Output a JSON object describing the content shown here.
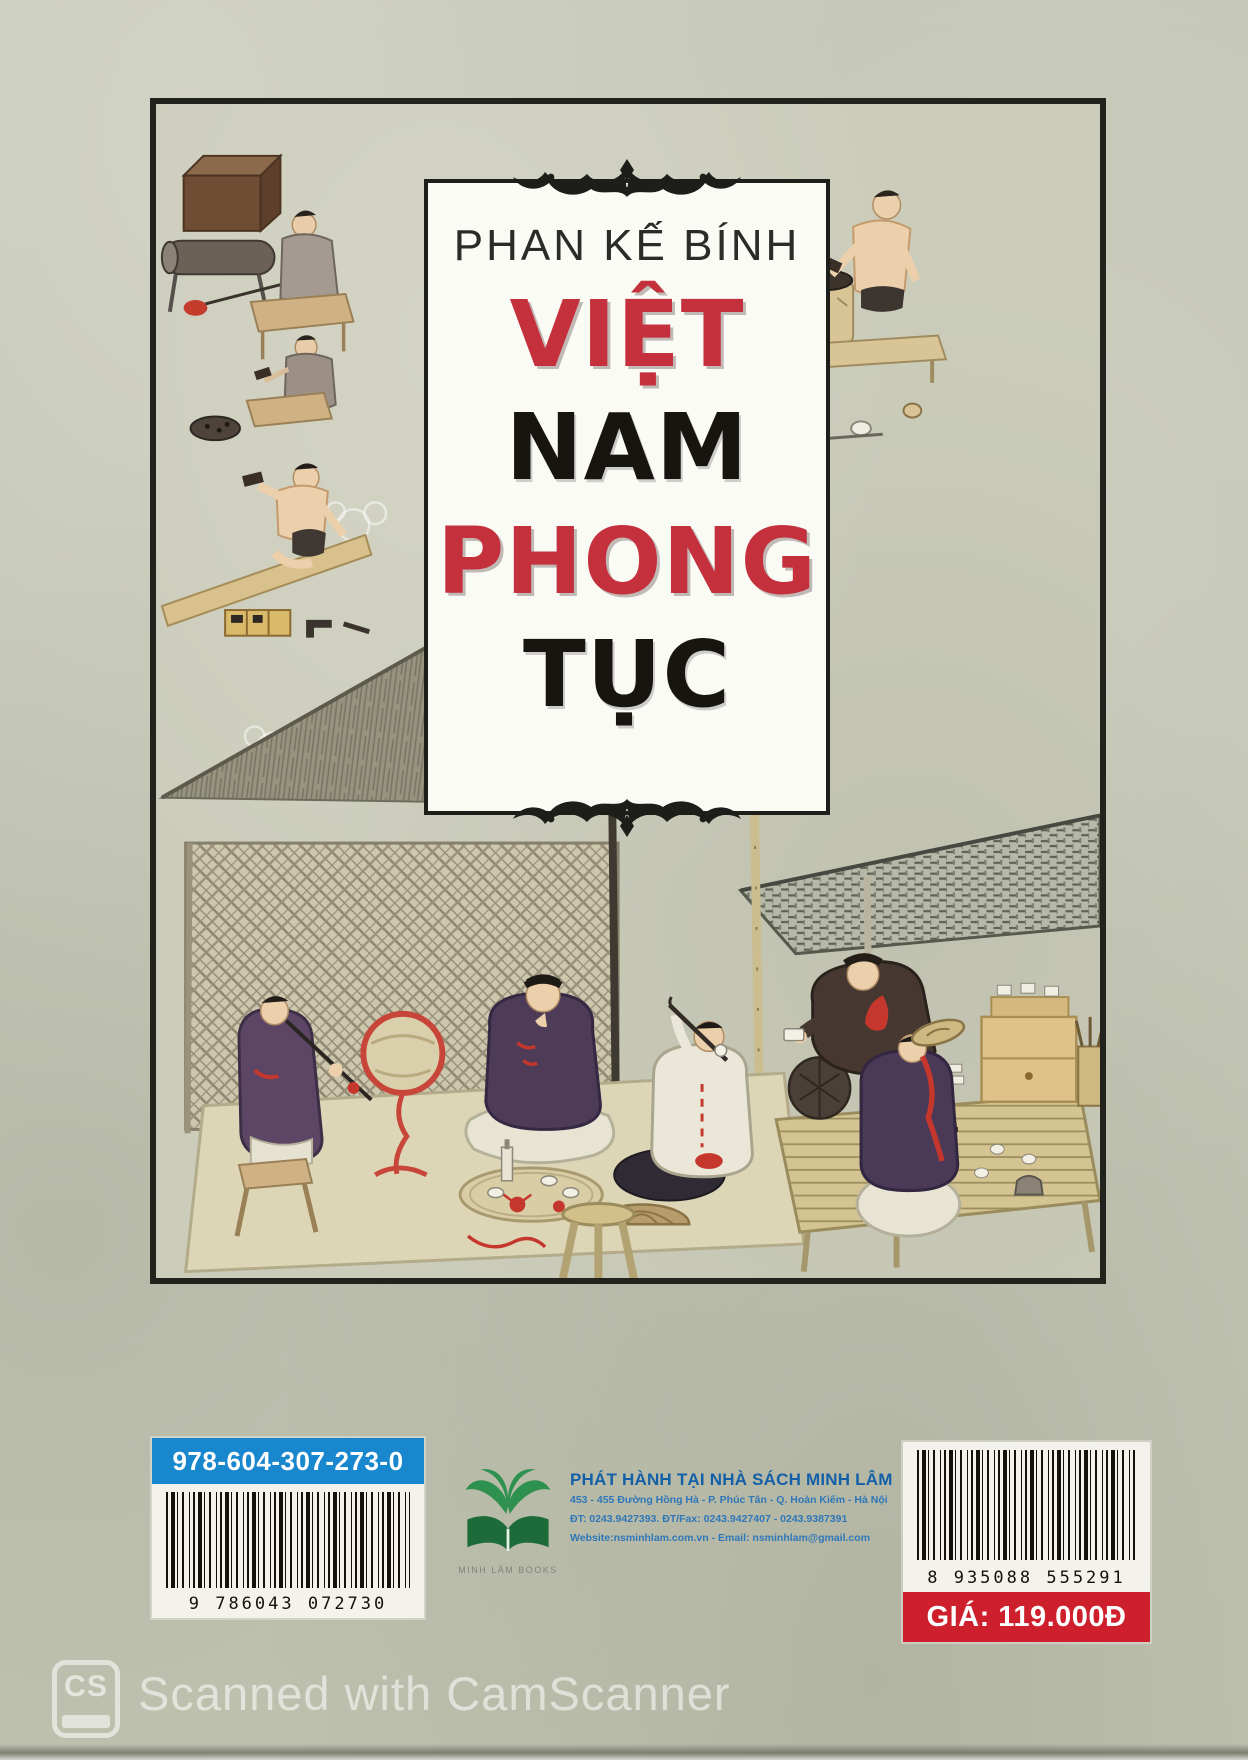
{
  "cover": {
    "author": "PHAN KẾ BÍNH",
    "words": [
      "VIỆT",
      "NAM",
      "PHONG",
      "TỤC"
    ]
  },
  "isbn": {
    "label": "978-604-307-273-0",
    "digits": "9 786043 072730"
  },
  "publisher": {
    "logo_caption": "MINH LÂM BOOKS",
    "lines": [
      "PHÁT HÀNH TẠI NHÀ SÁCH MINH LÂM",
      "453 - 455 Đường Hồng Hà - P. Phúc Tân - Q. Hoàn Kiếm - Hà Nội",
      "ĐT: 0243.9427393. ĐT/Fax: 0243.9427407 - 0243.9387391",
      "Website:nsminhlam.com.vn - Email: nsminhlam@gmail.com"
    ]
  },
  "price": {
    "digits": "8 935088 555291",
    "label": "GIÁ: 119.000Đ"
  },
  "watermark": {
    "logo_text": "CS",
    "text": "Scanned with CamScanner"
  },
  "colors": {
    "paper": "#c6c8b7",
    "frame": "#23231e",
    "title_red": "#c5303d",
    "title_black": "#181410",
    "isbn_blue": "#1987cd",
    "price_red": "#ce1f2d",
    "publisher_blue": "#1460a8",
    "logo_green": "#2f9150"
  }
}
